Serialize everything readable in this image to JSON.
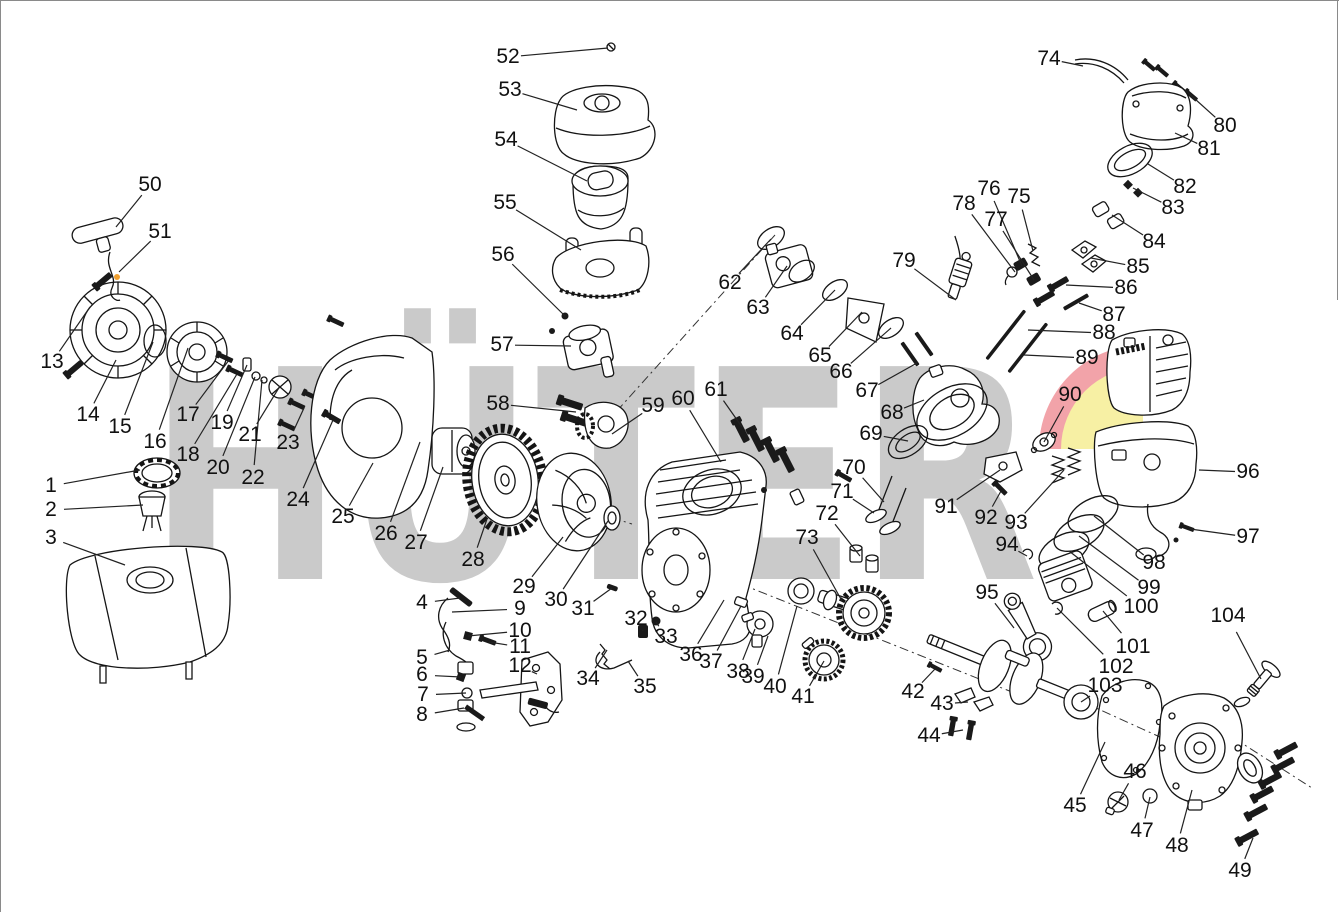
{
  "figure": {
    "type": "exploded-parts-diagram",
    "subject": "engine-spare-parts"
  },
  "canvas": {
    "width": 1339,
    "height": 912,
    "background": "#ffffff",
    "border_color": "#8a8a8a"
  },
  "watermark": {
    "text": "HÜTER",
    "letter_color": "#cacaca",
    "swirl_red": "#f2a3a9",
    "swirl_yellow": "#f7f0a4",
    "accent_dot": "#f0a030"
  },
  "label_style": {
    "font_size": 21,
    "color": "#111111",
    "leader_color": "#222222"
  },
  "parts": [
    {
      "n": "1",
      "x": 51,
      "y": 486,
      "tx": 140,
      "ty": 470
    },
    {
      "n": "2",
      "x": 51,
      "y": 510,
      "tx": 143,
      "ty": 505
    },
    {
      "n": "3",
      "x": 51,
      "y": 538,
      "tx": 125,
      "ty": 565
    },
    {
      "n": "4",
      "x": 422,
      "y": 603,
      "tx": 460,
      "ty": 598
    },
    {
      "n": "5",
      "x": 422,
      "y": 658,
      "tx": 450,
      "ty": 650
    },
    {
      "n": "6",
      "x": 422,
      "y": 675,
      "tx": 461,
      "ty": 677
    },
    {
      "n": "7",
      "x": 423,
      "y": 695,
      "tx": 466,
      "ty": 693
    },
    {
      "n": "8",
      "x": 422,
      "y": 715,
      "tx": 464,
      "ty": 708
    },
    {
      "n": "9",
      "x": 520,
      "y": 609,
      "tx": 452,
      "ty": 612
    },
    {
      "n": "10",
      "x": 520,
      "y": 631,
      "tx": 468,
      "ty": 636
    },
    {
      "n": "11",
      "x": 520,
      "y": 647,
      "tx": 489,
      "ty": 642
    },
    {
      "n": "12",
      "x": 520,
      "y": 666,
      "tx": 537,
      "ty": 674
    },
    {
      "n": "13",
      "x": 52,
      "y": 362,
      "tx": 90,
      "ty": 307
    },
    {
      "n": "14",
      "x": 88,
      "y": 415,
      "tx": 116,
      "ty": 360
    },
    {
      "n": "15",
      "x": 120,
      "y": 427,
      "tx": 153,
      "ty": 342
    },
    {
      "n": "16",
      "x": 155,
      "y": 442,
      "tx": 188,
      "ty": 348
    },
    {
      "n": "17",
      "x": 188,
      "y": 415,
      "tx": 229,
      "ty": 360
    },
    {
      "n": "18",
      "x": 188,
      "y": 455,
      "tx": 237,
      "ty": 374
    },
    {
      "n": "19",
      "x": 222,
      "y": 423,
      "tx": 247,
      "ty": 365
    },
    {
      "n": "20",
      "x": 218,
      "y": 468,
      "tx": 255,
      "ty": 377
    },
    {
      "n": "21",
      "x": 250,
      "y": 435,
      "tx": 280,
      "ty": 386
    },
    {
      "n": "22",
      "x": 253,
      "y": 478,
      "tx": 262,
      "ty": 380
    },
    {
      "n": "23",
      "x": 288,
      "y": 443,
      "tx": 304,
      "ty": 408
    },
    {
      "n": "24",
      "x": 298,
      "y": 500,
      "tx": 333,
      "ty": 420
    },
    {
      "n": "25",
      "x": 343,
      "y": 517,
      "tx": 373,
      "ty": 463
    },
    {
      "n": "26",
      "x": 386,
      "y": 534,
      "tx": 420,
      "ty": 442
    },
    {
      "n": "27",
      "x": 416,
      "y": 543,
      "tx": 443,
      "ty": 467
    },
    {
      "n": "28",
      "x": 473,
      "y": 560,
      "tx": 487,
      "ty": 519
    },
    {
      "n": "29",
      "x": 524,
      "y": 587,
      "tx": 563,
      "ty": 537
    },
    {
      "n": "30",
      "x": 556,
      "y": 600,
      "tx": 608,
      "ty": 521
    },
    {
      "n": "31",
      "x": 583,
      "y": 609,
      "tx": 612,
      "ty": 588
    },
    {
      "n": "32",
      "x": 636,
      "y": 619,
      "tx": 643,
      "ty": 631
    },
    {
      "n": "33",
      "x": 666,
      "y": 637,
      "tx": 656,
      "ty": 622
    },
    {
      "n": "34",
      "x": 588,
      "y": 679,
      "tx": 607,
      "ty": 650
    },
    {
      "n": "35",
      "x": 645,
      "y": 687,
      "tx": 628,
      "ty": 661
    },
    {
      "n": "36",
      "x": 691,
      "y": 655,
      "tx": 724,
      "ty": 600
    },
    {
      "n": "37",
      "x": 711,
      "y": 662,
      "tx": 741,
      "ty": 606
    },
    {
      "n": "38",
      "x": 738,
      "y": 672,
      "tx": 755,
      "ty": 629
    },
    {
      "n": "39",
      "x": 753,
      "y": 677,
      "tx": 768,
      "ty": 636
    },
    {
      "n": "40",
      "x": 775,
      "y": 687,
      "tx": 797,
      "ty": 606
    },
    {
      "n": "41",
      "x": 803,
      "y": 697,
      "tx": 824,
      "ty": 661
    },
    {
      "n": "42",
      "x": 913,
      "y": 692,
      "tx": 935,
      "ty": 669
    },
    {
      "n": "43",
      "x": 942,
      "y": 704,
      "tx": 968,
      "ty": 702
    },
    {
      "n": "44",
      "x": 929,
      "y": 736,
      "tx": 963,
      "ty": 730
    },
    {
      "n": "45",
      "x": 1075,
      "y": 806,
      "tx": 1105,
      "ty": 742
    },
    {
      "n": "46",
      "x": 1135,
      "y": 772,
      "tx": 1119,
      "ty": 800
    },
    {
      "n": "47",
      "x": 1142,
      "y": 831,
      "tx": 1150,
      "ty": 797
    },
    {
      "n": "48",
      "x": 1177,
      "y": 846,
      "tx": 1192,
      "ty": 790
    },
    {
      "n": "49",
      "x": 1240,
      "y": 871,
      "tx": 1253,
      "ty": 838
    },
    {
      "n": "50",
      "x": 150,
      "y": 185,
      "tx": 116,
      "ty": 227
    },
    {
      "n": "51",
      "x": 160,
      "y": 232,
      "tx": 119,
      "ty": 272
    },
    {
      "n": "52",
      "x": 508,
      "y": 57,
      "tx": 608,
      "ty": 48
    },
    {
      "n": "53",
      "x": 510,
      "y": 90,
      "tx": 577,
      "ty": 110
    },
    {
      "n": "54",
      "x": 506,
      "y": 140,
      "tx": 587,
      "ty": 181
    },
    {
      "n": "55",
      "x": 505,
      "y": 203,
      "tx": 581,
      "ty": 250
    },
    {
      "n": "56",
      "x": 503,
      "y": 255,
      "tx": 565,
      "ty": 316
    },
    {
      "n": "57",
      "x": 502,
      "y": 345,
      "tx": 571,
      "ty": 346
    },
    {
      "n": "58",
      "x": 498,
      "y": 404,
      "tx": 576,
      "ty": 412
    },
    {
      "n": "59",
      "x": 653,
      "y": 406,
      "tx": 612,
      "ty": 434
    },
    {
      "n": "60",
      "x": 683,
      "y": 399,
      "tx": 721,
      "ty": 462
    },
    {
      "n": "61",
      "x": 716,
      "y": 390,
      "tx": 742,
      "ty": 427
    },
    {
      "n": "62",
      "x": 730,
      "y": 283,
      "tx": 771,
      "ty": 239
    },
    {
      "n": "63",
      "x": 758,
      "y": 308,
      "tx": 787,
      "ty": 266
    },
    {
      "n": "64",
      "x": 792,
      "y": 334,
      "tx": 835,
      "ty": 290
    },
    {
      "n": "65",
      "x": 820,
      "y": 356,
      "tx": 862,
      "ty": 312
    },
    {
      "n": "66",
      "x": 841,
      "y": 372,
      "tx": 891,
      "ty": 328
    },
    {
      "n": "67",
      "x": 867,
      "y": 391,
      "tx": 917,
      "ty": 363
    },
    {
      "n": "68",
      "x": 892,
      "y": 413,
      "tx": 924,
      "ty": 400
    },
    {
      "n": "69",
      "x": 871,
      "y": 434,
      "tx": 908,
      "ty": 441
    },
    {
      "n": "70",
      "x": 854,
      "y": 468,
      "tx": 884,
      "ty": 502
    },
    {
      "n": "71",
      "x": 842,
      "y": 492,
      "tx": 874,
      "ty": 513
    },
    {
      "n": "72",
      "x": 827,
      "y": 514,
      "tx": 860,
      "ty": 556
    },
    {
      "n": "73",
      "x": 807,
      "y": 538,
      "tx": 842,
      "ty": 601
    },
    {
      "n": "74",
      "x": 1049,
      "y": 59,
      "tx": 1083,
      "ty": 66
    },
    {
      "n": "75",
      "x": 1019,
      "y": 197,
      "tx": 1033,
      "ty": 251
    },
    {
      "n": "76",
      "x": 989,
      "y": 189,
      "tx": 1022,
      "ty": 266
    },
    {
      "n": "77",
      "x": 996,
      "y": 220,
      "tx": 1034,
      "ty": 280
    },
    {
      "n": "78",
      "x": 964,
      "y": 204,
      "tx": 1015,
      "ty": 272
    },
    {
      "n": "79",
      "x": 904,
      "y": 261,
      "tx": 956,
      "ty": 300
    },
    {
      "n": "80",
      "x": 1225,
      "y": 126,
      "tx": 1185,
      "ty": 90
    },
    {
      "n": "81",
      "x": 1209,
      "y": 149,
      "tx": 1175,
      "ty": 133
    },
    {
      "n": "82",
      "x": 1185,
      "y": 187,
      "tx": 1148,
      "ty": 164
    },
    {
      "n": "83",
      "x": 1173,
      "y": 208,
      "tx": 1133,
      "ty": 188
    },
    {
      "n": "84",
      "x": 1154,
      "y": 242,
      "tx": 1112,
      "ty": 215
    },
    {
      "n": "85",
      "x": 1138,
      "y": 267,
      "tx": 1091,
      "ty": 258
    },
    {
      "n": "86",
      "x": 1126,
      "y": 288,
      "tx": 1066,
      "ty": 285
    },
    {
      "n": "87",
      "x": 1114,
      "y": 315,
      "tx": 1079,
      "ty": 303
    },
    {
      "n": "88",
      "x": 1104,
      "y": 333,
      "tx": 1028,
      "ty": 330
    },
    {
      "n": "89",
      "x": 1087,
      "y": 358,
      "tx": 1024,
      "ty": 355
    },
    {
      "n": "90",
      "x": 1070,
      "y": 395,
      "tx": 1044,
      "ty": 442
    },
    {
      "n": "91",
      "x": 946,
      "y": 507,
      "tx": 1000,
      "ty": 470
    },
    {
      "n": "92",
      "x": 986,
      "y": 518,
      "tx": 1001,
      "ty": 491
    },
    {
      "n": "93",
      "x": 1016,
      "y": 523,
      "tx": 1064,
      "ty": 470
    },
    {
      "n": "94",
      "x": 1007,
      "y": 545,
      "tx": 1027,
      "ty": 556
    },
    {
      "n": "95",
      "x": 987,
      "y": 593,
      "tx": 1014,
      "ty": 628
    },
    {
      "n": "96",
      "x": 1248,
      "y": 472,
      "tx": 1199,
      "ty": 470
    },
    {
      "n": "97",
      "x": 1248,
      "y": 537,
      "tx": 1190,
      "ty": 529
    },
    {
      "n": "98",
      "x": 1154,
      "y": 563,
      "tx": 1094,
      "ty": 516
    },
    {
      "n": "99",
      "x": 1149,
      "y": 588,
      "tx": 1079,
      "ty": 536
    },
    {
      "n": "100",
      "x": 1141,
      "y": 607,
      "tx": 1069,
      "ty": 551
    },
    {
      "n": "101",
      "x": 1133,
      "y": 647,
      "tx": 1103,
      "ty": 611
    },
    {
      "n": "102",
      "x": 1116,
      "y": 667,
      "tx": 1057,
      "ty": 608
    },
    {
      "n": "103",
      "x": 1105,
      "y": 686,
      "tx": 1081,
      "ty": 702
    },
    {
      "n": "104",
      "x": 1228,
      "y": 616,
      "tx": 1261,
      "ty": 679
    }
  ]
}
